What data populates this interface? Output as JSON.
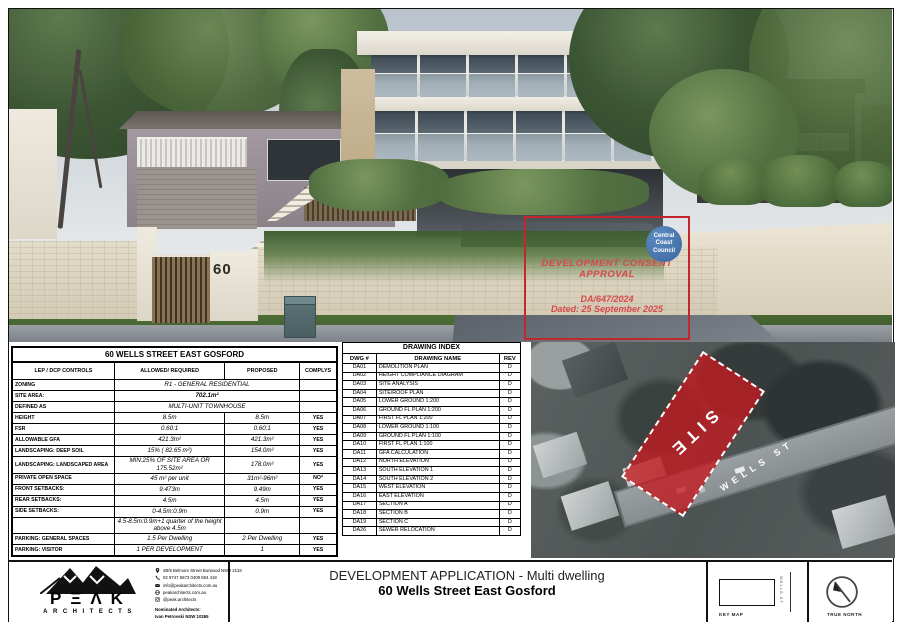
{
  "render": {
    "house_number": "60"
  },
  "stamp": {
    "title_line1": "DEVELOPMENT CONSENT",
    "title_line2": "APPROVAL",
    "reference": "DA/647/2024",
    "dated": "Dated:  25 September 2025",
    "council": {
      "line1": "Central",
      "line2": "Coast",
      "line3": "Council"
    }
  },
  "controls_table": {
    "title": "60 WELLS STREET EAST GOSFORD",
    "headers": [
      "LEP / DCP CONTROLS",
      "ALLOWED/ REQUIRED",
      "PROPOSED",
      "COMPLYS"
    ],
    "rows": [
      {
        "label": "ZONING",
        "value": "R1 - GENERAL RESIDENTIAL",
        "span": true,
        "cls": ""
      },
      {
        "label": "SITE AREA:",
        "value": "702.1m²",
        "span": true,
        "cls": "b"
      },
      {
        "label": "DEFINED AS",
        "value": "MULTI-UNIT  TOWNHOUSE",
        "span": true,
        "cls": ""
      },
      {
        "label": "HEIGHT",
        "allowed": "8.5m",
        "proposed": "8.5m",
        "complys": "YES"
      },
      {
        "label": "FSR",
        "allowed": "0.60:1",
        "proposed": "0.60:1",
        "complys": "YES"
      },
      {
        "label": "ALLOWABLE GFA",
        "allowed": "421.3m²",
        "proposed": "421.3m²",
        "complys": "YES"
      },
      {
        "label": "LANDSCAPING: DEEP SOIL",
        "allowed": "15% ( 82.65 m²)",
        "proposed": "154.0m²",
        "complys": "YES"
      },
      {
        "label": "LANDSCAPING: LANDSCAPED AREA",
        "allowed": "MIN.25% OF SITE AREA OR 175.52m²",
        "proposed": "178.0m²",
        "complys": "YES"
      },
      {
        "label": "PRIVATE OPEN SPACE",
        "allowed": "45 m² per unit",
        "proposed": "31m²-96m²",
        "complys": "NO*"
      },
      {
        "label": "FRONT SETBACKS:",
        "allowed": "9.473m",
        "proposed": "9.49m",
        "complys": "YES"
      },
      {
        "label": "REAR SETBACKS:",
        "allowed": "4.5m",
        "proposed": "4.5m",
        "complys": "YES"
      },
      {
        "label": "SIDE SETBACKS:",
        "allowed": "0-4.5m:0.9m",
        "proposed": "0.9m",
        "complys": "YES"
      },
      {
        "label": "",
        "allowed": "4.5-8.5m:0.9m+1 quarter of the height above 4.5m",
        "proposed": "",
        "complys": ""
      },
      {
        "label": "PARKING: GENERAL SPACES",
        "allowed": "1.5 Per Dwelling",
        "proposed": "2 Per Dwelling",
        "complys": "YES"
      },
      {
        "label": "PARKING: VISITOR",
        "allowed": "1 PER DEVELOPMENT",
        "proposed": "1",
        "complys": "YES"
      }
    ]
  },
  "drawing_index": {
    "title": "DRAWING INDEX",
    "headers": [
      "DWG #",
      "DRAWING NAME",
      "REV"
    ],
    "rows": [
      [
        "DA01",
        "DEMOLITION PLAN",
        "D"
      ],
      [
        "DA02",
        "HEIGHT COMPLIANCE DIAGRAM",
        "D"
      ],
      [
        "DA03",
        "SITE ANALYSIS",
        "D"
      ],
      [
        "DA04",
        "SITE/ROOF PLAN",
        "D"
      ],
      [
        "DA05",
        "LOWER GROUND 1:200",
        "D"
      ],
      [
        "DA06",
        "GROUND FL PLAN 1:200",
        "D"
      ],
      [
        "DA07",
        "FIRST FL PLAN 1:200",
        "D"
      ],
      [
        "DA08",
        "LOWER GROUND 1:100",
        "D"
      ],
      [
        "DA09",
        "GROUND FL PLAN 1:100",
        "D"
      ],
      [
        "DA10",
        "FIRST FL PLAN 1:100",
        "D"
      ],
      [
        "DA11",
        "GFA CALCULATION",
        "D"
      ],
      [
        "DA12",
        "NORTH ELEVATION",
        "D"
      ],
      [
        "DA13",
        "SOUTH ELEVATION 1",
        "D"
      ],
      [
        "DA14",
        "SOUTH ELEVATION 2",
        "D"
      ],
      [
        "DA15",
        "WEST ELEVATION",
        "D"
      ],
      [
        "DA16",
        "EAST ELEVATION",
        "D"
      ],
      [
        "DA17",
        "SECTION A",
        "D"
      ],
      [
        "DA18",
        "SECTION B",
        "D"
      ],
      [
        "DA19",
        "SECTION C",
        "D"
      ],
      [
        "DA26",
        "SEWER RELOCATION",
        "D"
      ]
    ]
  },
  "aerial": {
    "site_label": "SITE",
    "street_label": "WELLS ST"
  },
  "title_block": {
    "logo_word": "PΞΛK",
    "logo_sub": "ARCHITECTS",
    "contact": [
      {
        "icon": "location-pin",
        "text": "2B/5 Belmore Street   Burwood NSW 2134"
      },
      {
        "icon": "phone",
        "text": "02 9747 5673      0408 654 418"
      },
      {
        "icon": "email",
        "text": "info@peakarchitects.com.au"
      },
      {
        "icon": "globe",
        "text": "peakarchitects.com.au"
      },
      {
        "icon": "instagram",
        "text": "@peak.architects"
      }
    ],
    "nominated_1": "Nominated Architects:",
    "nominated_2": "Ivan Petrovski NSW 10265",
    "project_type": "DEVELOPMENT APPLICATION - Multi dwelling",
    "project_address": "60 Wells Street East Gosford",
    "key_map_label": "KEY MAP",
    "key_map_street": "WELLS ST",
    "true_north_label": "TRUE NORTH"
  },
  "colors": {
    "stamp_red": "#c4262e",
    "site_overlay_red": "#c01b22",
    "council_blue": "#3a66a0"
  }
}
